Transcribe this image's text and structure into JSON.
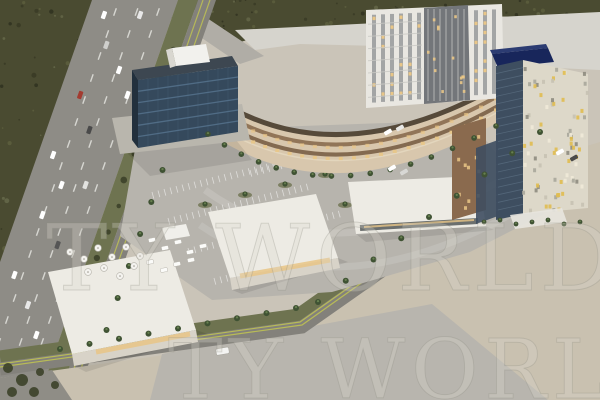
{
  "alt": "Aerial 3D architectural rendering of a mixed-use retail and hotel development with parking lot, palm trees and an adjacent multi-lane highway",
  "watermarks": {
    "middle": "TY WORLD",
    "bottom": "TY WORLD"
  },
  "palette": {
    "site": "#cac4b8",
    "vegetation": "#4a4b31",
    "vegetation-dark": "#383a25",
    "vegetation-light": "#65684a",
    "roofs-light": "#d6d4cd",
    "ramp": "#b0ada6",
    "highway": "#8e8c86",
    "lane-marking": "#e9e8e3",
    "verge": "#6e7350",
    "street": "#83817b",
    "bike-line": "#c6c94e",
    "palm": "#3f5233",
    "palm-light": "#67804f",
    "parking": "#b7b4ad",
    "stall-line": "#ffffff",
    "vacant": "#c9c1b0",
    "concrete": "#b8b5ae",
    "retail-facade": "#d8c7ad",
    "retail-roof": "#564a3a",
    "retail-band": "#8a6b4f",
    "lit-window": "#e9c687",
    "office-glass": "#35495c",
    "office-dark": "#22303d",
    "office-line": "#54708a",
    "office-roof": "#3d4751",
    "roofbox": "#f2f1ed",
    "tower-white": "#e9e7e1",
    "tower-strip": "#97999a",
    "tower-core": "#73767a",
    "hotel-sign": "#18265b",
    "hotel-sign-top": "#2c3c72",
    "hotel-glass": "#3e4e60",
    "hotel-face": "#ddd8c9",
    "mosaic-yellow": "#e0bd50",
    "bronze": "#8a6a4e",
    "pad-roof": "#edebe4",
    "pad-front": "#d8d3c8",
    "watermark": "#d9d6ce",
    "watermark-stroke": "#8a887f"
  }
}
